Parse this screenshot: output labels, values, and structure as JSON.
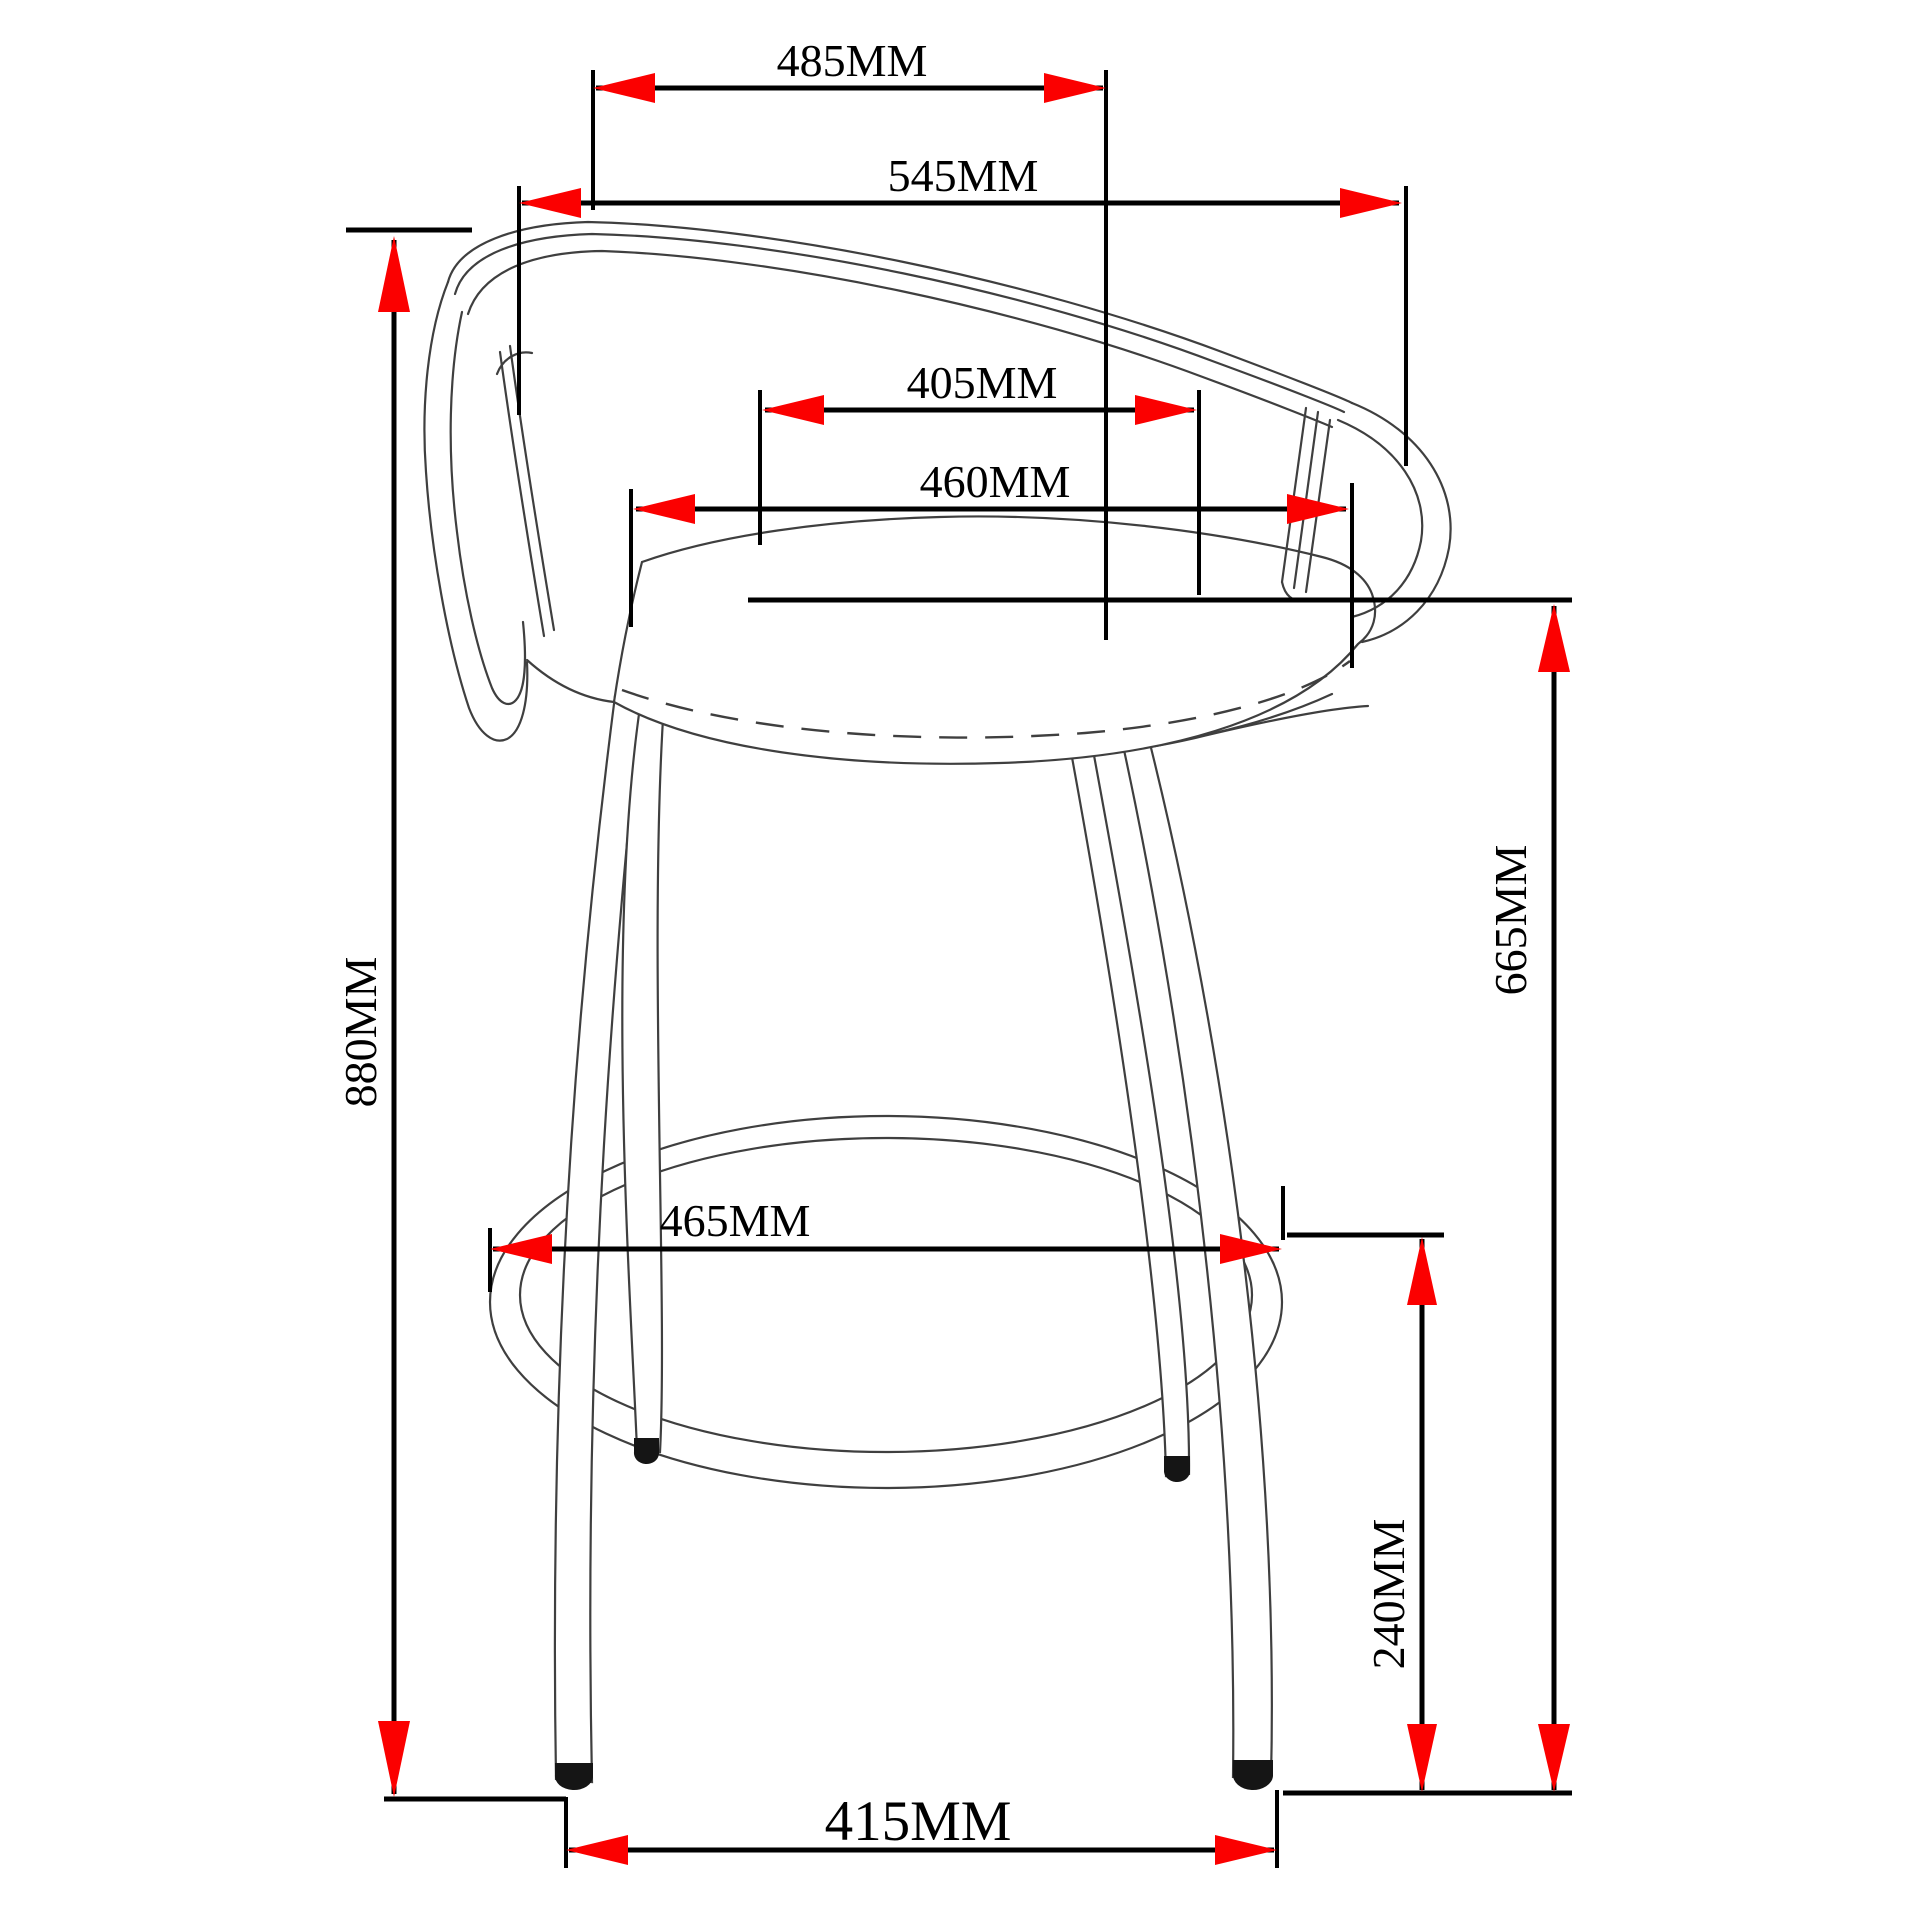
{
  "colors": {
    "background": "#ffffff",
    "dimension": "#000000",
    "arrow": "#fb0000",
    "chair": "#3f3f3f",
    "text": "#000000"
  },
  "dimensions": {
    "d485": {
      "label": "485MM"
    },
    "d545": {
      "label": "545MM"
    },
    "d405": {
      "label": "405MM"
    },
    "d460": {
      "label": "460MM"
    },
    "d880": {
      "label": "880MM"
    },
    "d665": {
      "label": "665MM"
    },
    "d465": {
      "label": "465MM"
    },
    "d240": {
      "label": "240MM"
    },
    "d415": {
      "label": "415MM"
    }
  }
}
